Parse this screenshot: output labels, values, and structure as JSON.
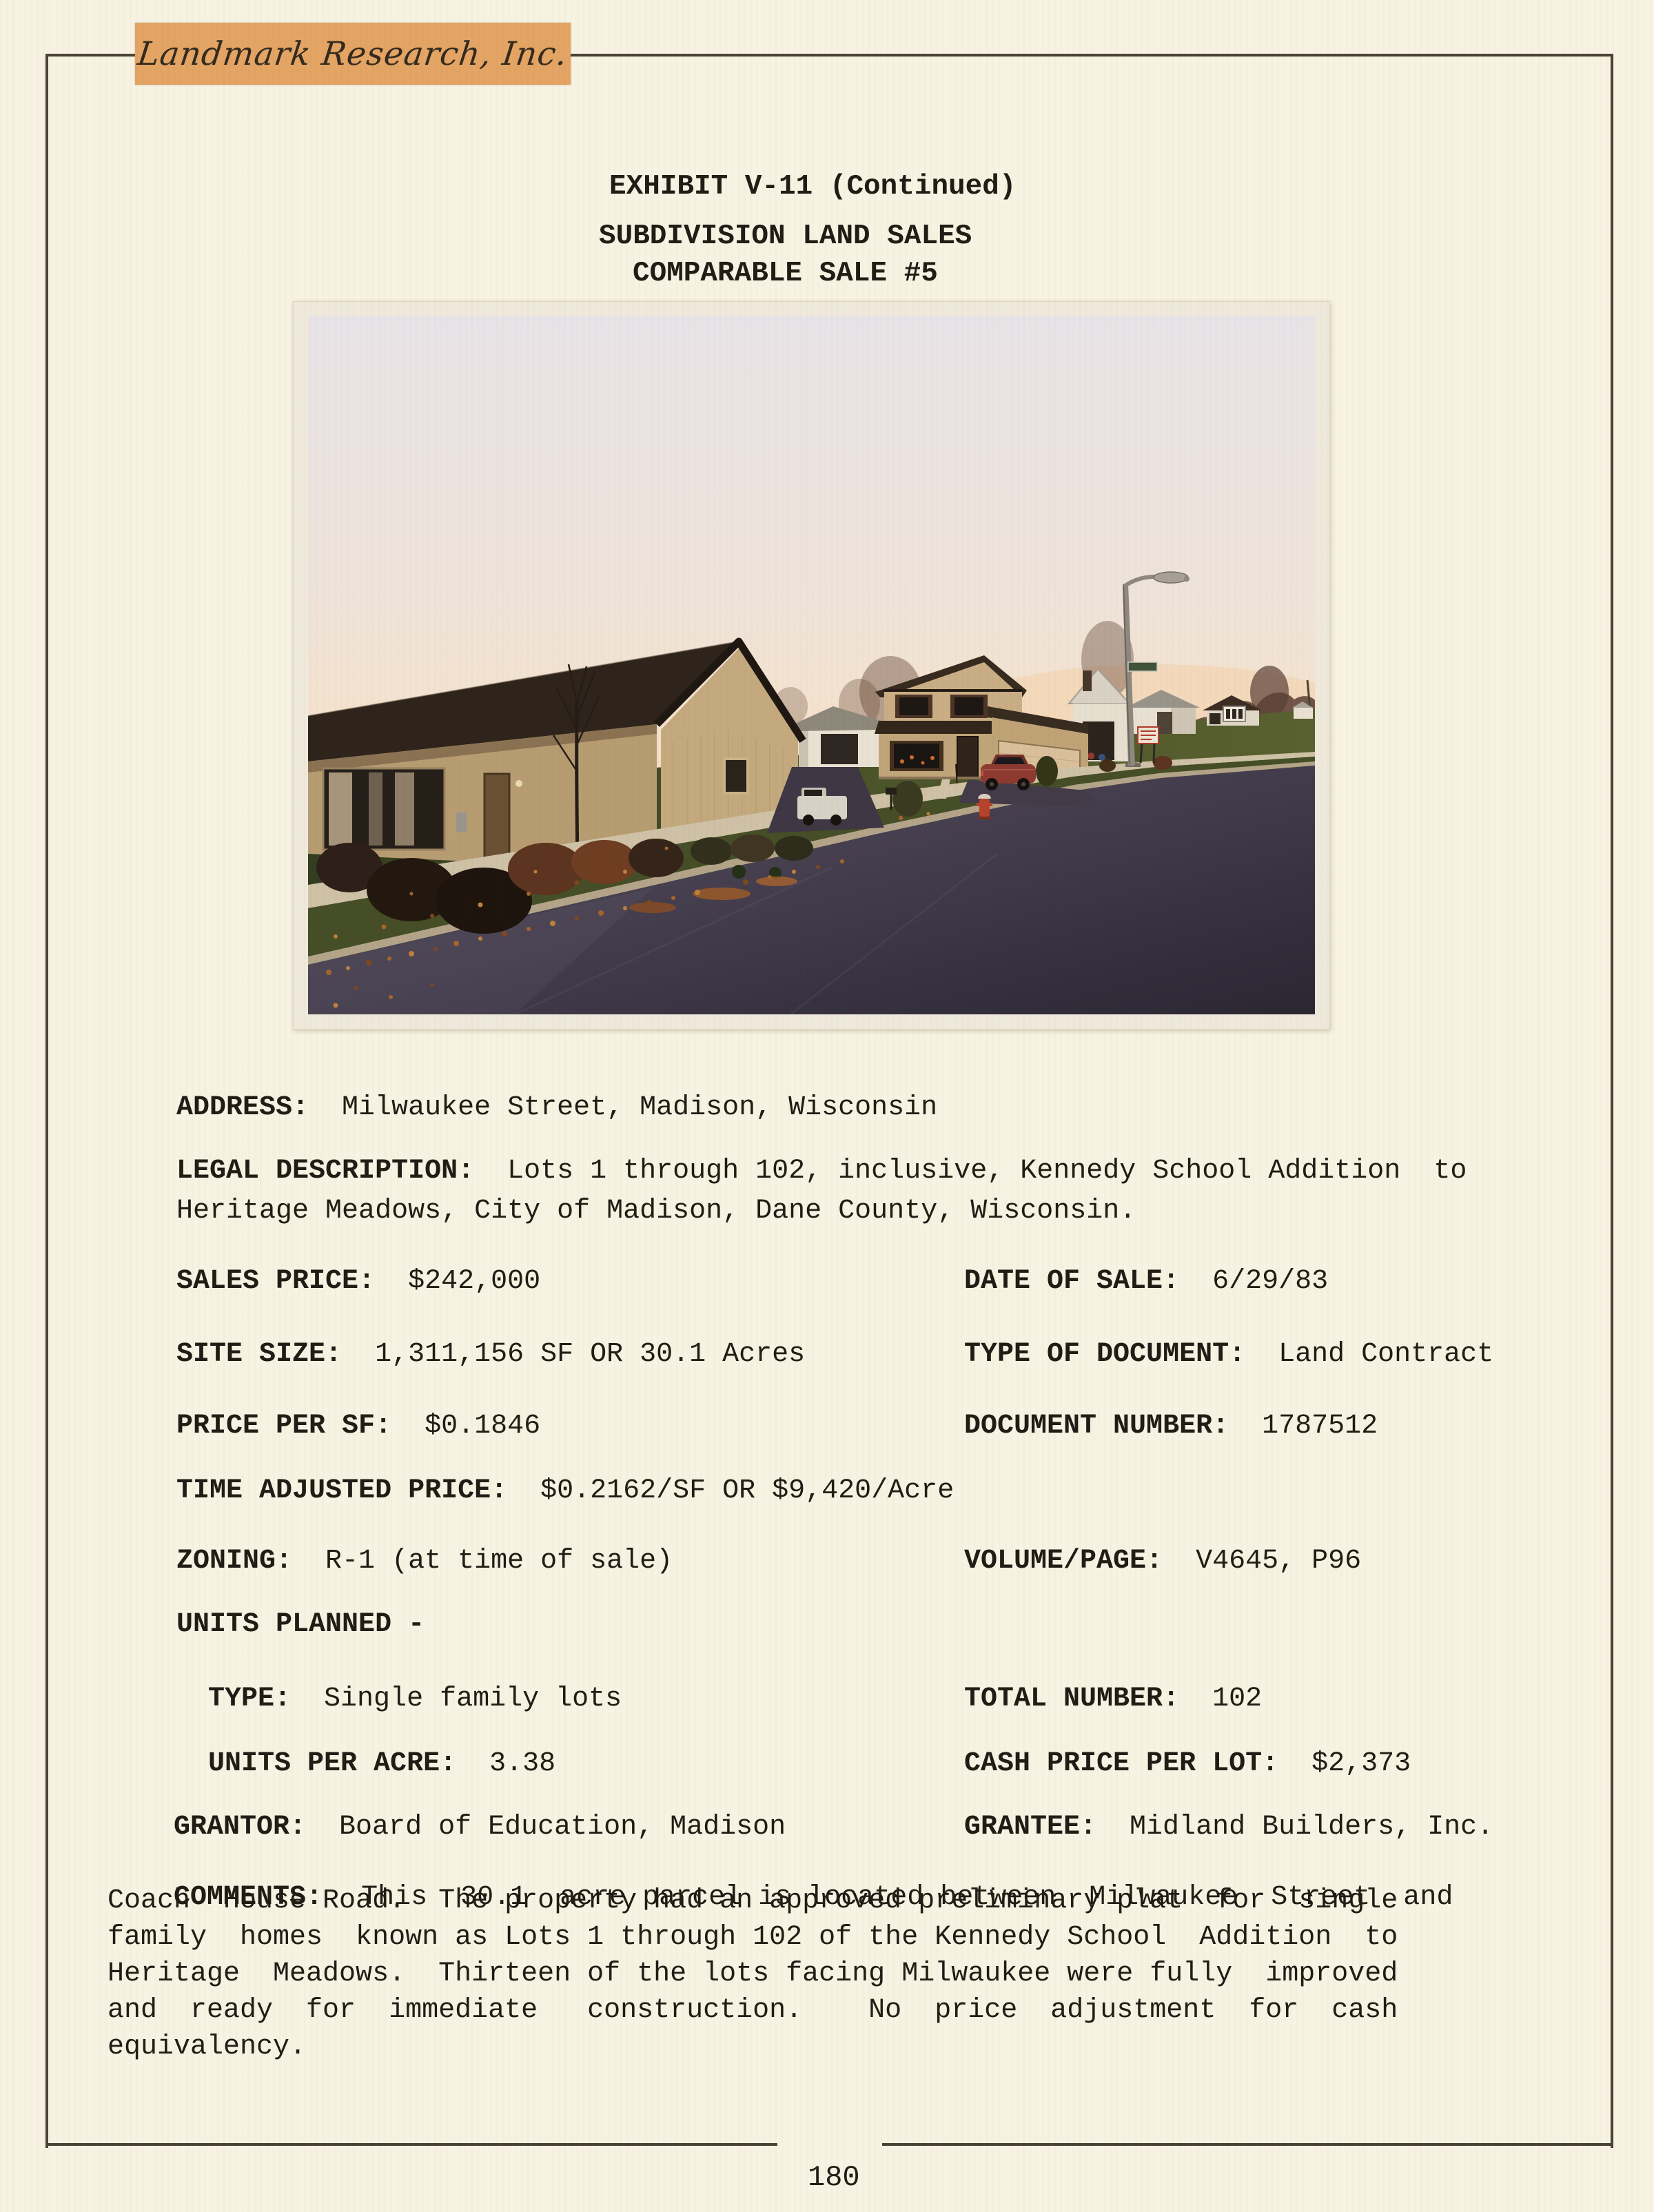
{
  "logo": {
    "text": "Landmark Research, Inc."
  },
  "header": {
    "line1": "EXHIBIT V-11 (Continued)",
    "line2": "SUBDIVISION LAND SALES",
    "line3": "COMPARABLE SALE #5"
  },
  "fields": {
    "address": {
      "label": "ADDRESS:",
      "value": "Milwaukee Street, Madison, Wisconsin"
    },
    "legal_description": {
      "label": "LEGAL DESCRIPTION:",
      "value_line1": "Lots 1 through 102, inclusive, Kennedy School Addition  to",
      "value_line2": "Heritage Meadows, City of Madison, Dane County, Wisconsin."
    },
    "sales_price": {
      "label": "SALES PRICE:",
      "value": "$242,000"
    },
    "date_of_sale": {
      "label": "DATE OF SALE:",
      "value": "6/29/83"
    },
    "site_size": {
      "label": "SITE SIZE:",
      "value": "1,311,156 SF OR 30.1 Acres"
    },
    "type_of_document": {
      "label": "TYPE OF DOCUMENT:",
      "value": "Land Contract"
    },
    "price_per_sf": {
      "label": "PRICE PER SF:",
      "value": "$0.1846"
    },
    "document_number": {
      "label": "DOCUMENT NUMBER:",
      "value": "1787512"
    },
    "time_adjusted_price": {
      "label": "TIME ADJUSTED PRICE:",
      "value": "$0.2162/SF OR $9,420/Acre"
    },
    "zoning": {
      "label": "ZONING:",
      "value": "R-1 (at time of sale)"
    },
    "volume_page": {
      "label": "VOLUME/PAGE:",
      "value": "V4645, P96"
    },
    "units_planned": {
      "label": "UNITS PLANNED -"
    },
    "unit_type": {
      "label": "TYPE:",
      "value": "Single family lots"
    },
    "total_number": {
      "label": "TOTAL NUMBER:",
      "value": "102"
    },
    "units_per_acre": {
      "label": "UNITS PER ACRE:",
      "value": "3.38"
    },
    "cash_price_per_lot": {
      "label": "CASH PRICE PER LOT:",
      "value": "$2,373"
    },
    "grantor": {
      "label": "GRANTOR:",
      "value": "Board of Education, Madison"
    },
    "grantee": {
      "label": "GRANTEE:",
      "value": "Midland Builders, Inc."
    }
  },
  "comments": {
    "label": "COMMENTS:",
    "line1_rest": "This  30.1  acre parcel is located between  Milwaukee  Street  and",
    "line2": "Coach  House Road.  The property had an approved preliminary plat  for  single",
    "line3": "family  homes  known as Lots 1 through 102 of the Kennedy School  Addition  to",
    "line4": "Heritage  Meadows.  Thirteen of the lots facing Milwaukee were fully  improved",
    "line5": "and  ready  for  immediate   construction.    No  price  adjustment  for  cash",
    "line6": "equivalency."
  },
  "footer": {
    "page_number": "180"
  },
  "colors": {
    "paper": "#f7f2e1",
    "ink": "#211c15",
    "border": "#4a4336",
    "label_orange": "#e3a464"
  }
}
